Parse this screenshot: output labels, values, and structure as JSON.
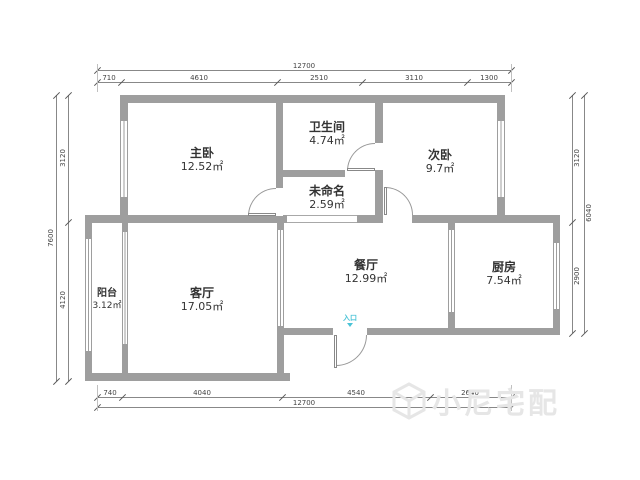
{
  "plan": {
    "wall_color": "#9e9e9e",
    "rooms": [
      {
        "name": "主卧",
        "area": "12.52㎡"
      },
      {
        "name": "卫生间",
        "area": "4.74㎡"
      },
      {
        "name": "次卧",
        "area": "9.7㎡"
      },
      {
        "name": "未命名",
        "area": "2.59㎡"
      },
      {
        "name": "餐厅",
        "area": "12.99㎡"
      },
      {
        "name": "厨房",
        "area": "7.54㎡"
      },
      {
        "name": "客厅",
        "area": "17.05㎡"
      },
      {
        "name": "阳台",
        "area": "3.12㎡"
      }
    ],
    "entry": {
      "label": "入口",
      "color": "#4ac3d6"
    },
    "dimensions": {
      "top": {
        "total": "12700",
        "segments": [
          "710",
          "4610",
          "2510",
          "3110",
          "1300"
        ]
      },
      "bottom": {
        "total": "12700",
        "segments": [
          "740",
          "4040",
          "4540",
          "2640"
        ]
      },
      "left": {
        "total": "7600",
        "segments": [
          "3120",
          "4120"
        ]
      },
      "right": {
        "total": "6040",
        "segments": [
          "3120",
          "2900"
        ]
      }
    }
  },
  "watermark": {
    "brand": "小尼宅配",
    "logo": "cube-logo"
  }
}
